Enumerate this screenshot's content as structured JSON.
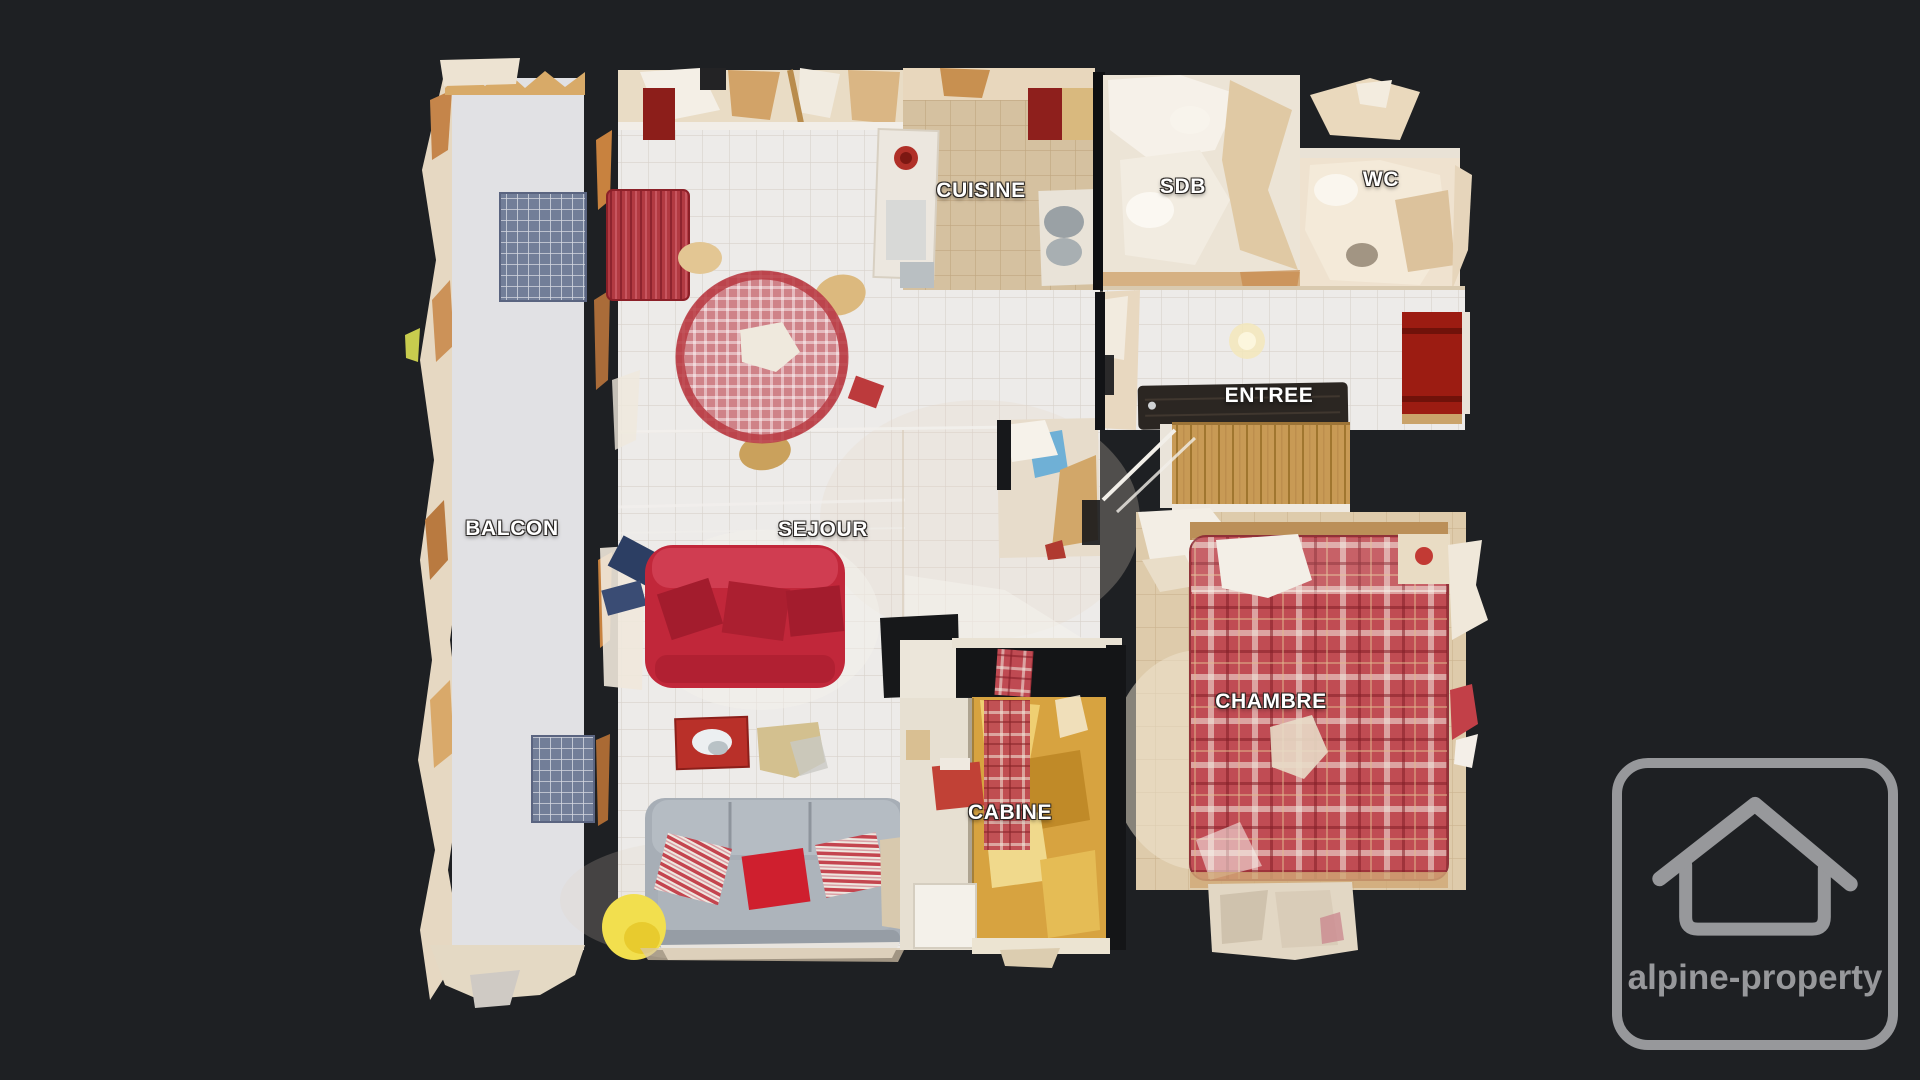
{
  "scene": {
    "type": "3d-scan-floorplan-top-view",
    "description": "Top-down dollhouse view of a one-bedroom apartment 3D scan on dark background"
  },
  "rooms": [
    {
      "id": "balcon",
      "label": "BALCON"
    },
    {
      "id": "sejour",
      "label": "SEJOUR"
    },
    {
      "id": "cuisine",
      "label": "CUISINE"
    },
    {
      "id": "sdb",
      "label": "SDB"
    },
    {
      "id": "wc",
      "label": "WC"
    },
    {
      "id": "entree",
      "label": "ENTREE"
    },
    {
      "id": "chambre",
      "label": "CHAMBRE"
    },
    {
      "id": "cabine",
      "label": "CABINE"
    }
  ],
  "watermark": {
    "brand": "alpine-property",
    "icon": "house-icon",
    "color": "#97989b"
  },
  "palette": {
    "background": "#1e2023",
    "label_text": "#ffffff",
    "label_outline": "#232020",
    "watermark_gray": "#97989b",
    "white_tile_floor": "#edebe9",
    "warm_tile_floor": "#decbab",
    "kitchen_floor": "#d5c1a0",
    "balcony_floor": "#e1e1e4",
    "red_sofa": "#c1273a",
    "bed_plaid_red": "#c04a52",
    "gray_sofa": "#a7aeb6",
    "cabine_gold": "#d7a340",
    "front_door_red": "#9c1c12",
    "entrance_mat": "#2b2622",
    "parquet_wood": "#c89a55"
  }
}
